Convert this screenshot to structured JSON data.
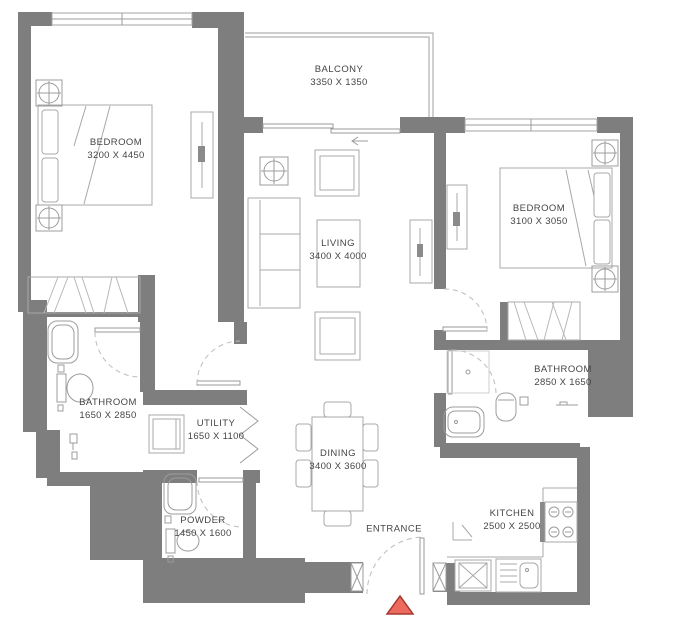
{
  "meta": {
    "drawing_type": "apartment floor plan"
  },
  "colors": {
    "wall": "#7e7e7e",
    "furniture_line": "#a8a8a8",
    "text": "#454545",
    "marker_fill": "#ed6a5e",
    "marker_stroke": "#a83a31",
    "background": "#ffffff"
  },
  "rooms": [
    {
      "id": "bedroom-1",
      "name": "BEDROOM",
      "dims": "3200 X 4450"
    },
    {
      "id": "balcony",
      "name": "BALCONY",
      "dims": "3350 X 1350"
    },
    {
      "id": "living",
      "name": "LIVING",
      "dims": "3400 X 4000"
    },
    {
      "id": "bedroom-2",
      "name": "BEDROOM",
      "dims": "3100 X 3050"
    },
    {
      "id": "bathroom-1",
      "name": "BATHROOM",
      "dims": "1650 X 2850"
    },
    {
      "id": "utility",
      "name": "UTILITY",
      "dims": "1650 X 1100"
    },
    {
      "id": "powder",
      "name": "POWDER",
      "dims": "1450 X 1600"
    },
    {
      "id": "dining",
      "name": "DINING",
      "dims": "3400 X 3600"
    },
    {
      "id": "kitchen",
      "name": "KITCHEN",
      "dims": "2500 X 2500"
    },
    {
      "id": "bathroom-2",
      "name": "BATHROOM",
      "dims": "2850 X 1650"
    }
  ],
  "entrance": {
    "label": "ENTRANCE"
  }
}
